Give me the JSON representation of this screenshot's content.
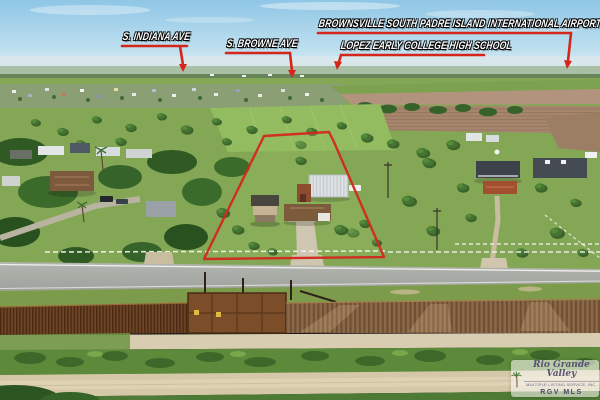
{
  "annotations": {
    "labels": [
      {
        "id": "indiana",
        "text": "S. Indiana Ave"
      },
      {
        "id": "browne",
        "text": "S. Browne Ave"
      },
      {
        "id": "airport",
        "text": "Brownsville South Padre Island International Airport"
      },
      {
        "id": "lopez",
        "text": "Lopez Early College High School"
      }
    ]
  },
  "watermark": {
    "brokerage": "Rio Grande Valley",
    "subtitle": "Multiple Listing Service, Inc.",
    "abbrev": "RGV MLS"
  },
  "colors": {
    "annotation_red": "#d6251b",
    "boundary_red": "#d2281e"
  }
}
